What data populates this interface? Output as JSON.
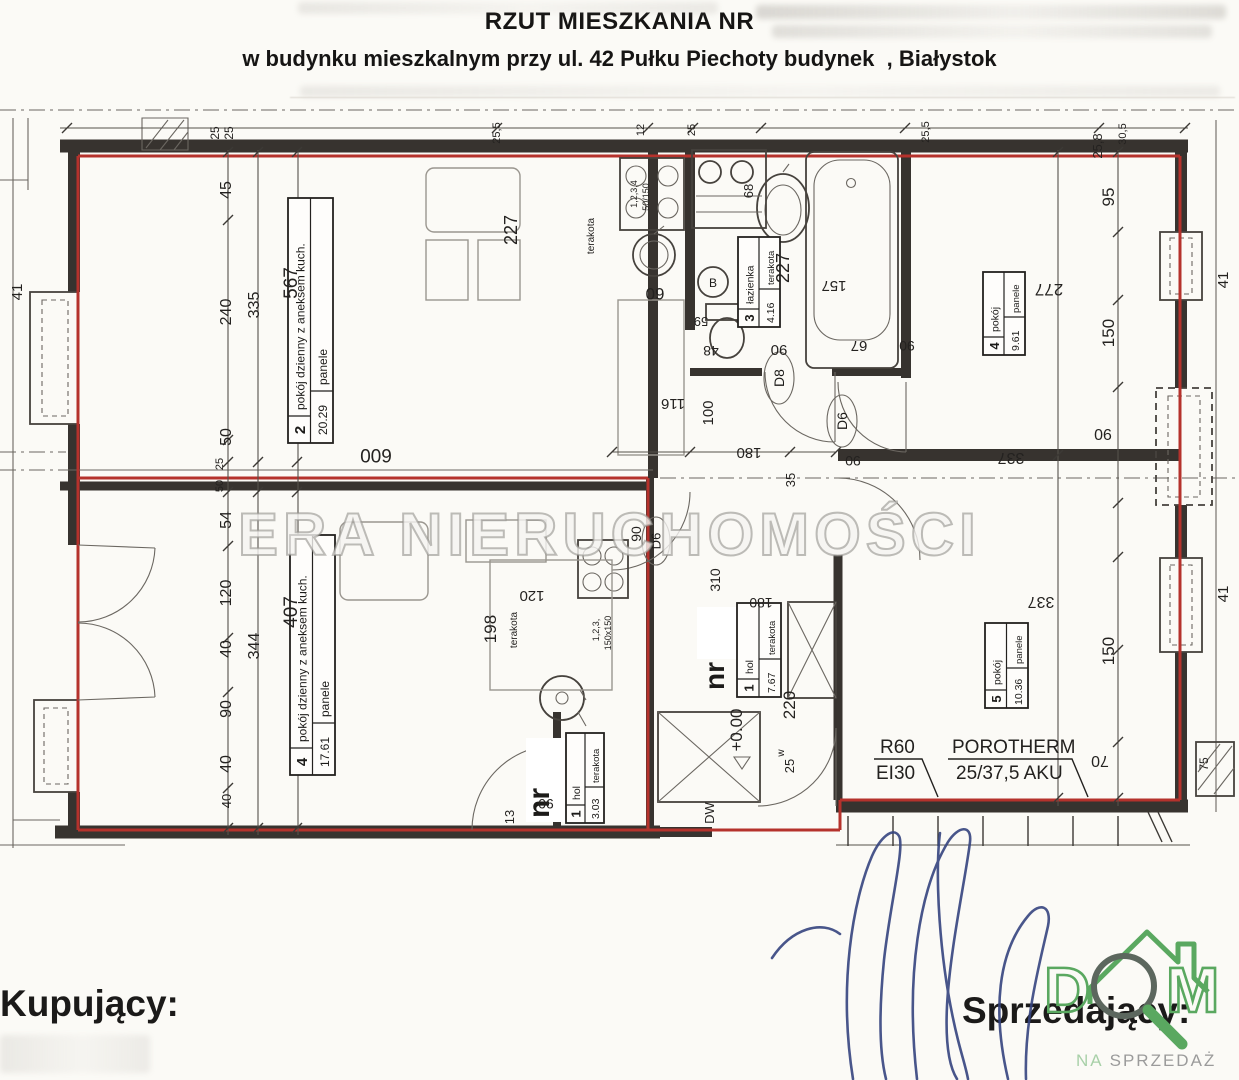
{
  "header": {
    "title": "RZUT MIESZKANIA NR",
    "subtitle": "w budynku mieszkalnym przy ul. 42 Pułku Piechoty budynek  , Białystok"
  },
  "watermark": "ERA NIERUCHOMOŚCI",
  "rooms": [
    {
      "num": "2",
      "name": "pokój dzienny z aneksem kuch.",
      "area": "20.29",
      "floor": "panele"
    },
    {
      "num": "4",
      "name": "pokój dzienny z aneksem kuch.",
      "area": "17.61",
      "floor": "panele"
    },
    {
      "num": "1",
      "name": "hol",
      "area": "3.03",
      "floor": "terakota"
    },
    {
      "num": "3",
      "name": "łazienka",
      "area": "4.16",
      "floor": "terakota"
    },
    {
      "num": "4",
      "name": "pokój",
      "area": "9.61",
      "floor": "panele"
    },
    {
      "num": "5",
      "name": "pokój",
      "area": "10.36",
      "floor": "panele"
    },
    {
      "num": "1",
      "name": "hol",
      "area": "7.67",
      "floor": "terakota"
    }
  ],
  "labels": {
    "apartment_no": "nr",
    "level": "+0.00",
    "entrance_door": "DW",
    "door_d8": "D8",
    "door_d6": "D6",
    "washer": "B",
    "fire_rating_1": "R60",
    "fire_rating_2": "EI30",
    "wall_material_1": "POROTHERM",
    "wall_material_2": "25/37,5 AKU"
  },
  "dim_labels": [
    {
      "t": "25",
      "x": 219,
      "y": 133,
      "r": -90,
      "s": 12
    },
    {
      "t": "25",
      "x": 233,
      "y": 133,
      "r": -90,
      "s": 12
    },
    {
      "t": "45",
      "x": 231,
      "y": 190,
      "r": -90,
      "s": 16
    },
    {
      "t": "240",
      "x": 231,
      "y": 312,
      "r": -90,
      "s": 16
    },
    {
      "t": "50",
      "x": 231,
      "y": 437,
      "r": -90,
      "s": 16
    },
    {
      "t": "335",
      "x": 259,
      "y": 305,
      "r": -90,
      "s": 16
    },
    {
      "t": "567",
      "x": 297,
      "y": 283,
      "r": -90,
      "s": 19
    },
    {
      "t": "600",
      "x": 376,
      "y": 449,
      "r": 180,
      "s": 19
    },
    {
      "t": "25",
      "x": 223,
      "y": 464,
      "r": -90,
      "s": 11
    },
    {
      "t": "50",
      "x": 223,
      "y": 486,
      "r": -90,
      "s": 11
    },
    {
      "t": "54",
      "x": 231,
      "y": 520,
      "r": -90,
      "s": 16
    },
    {
      "t": "120",
      "x": 231,
      "y": 593,
      "r": -90,
      "s": 16
    },
    {
      "t": "40",
      "x": 231,
      "y": 649,
      "r": -90,
      "s": 16
    },
    {
      "t": "90",
      "x": 231,
      "y": 709,
      "r": -90,
      "s": 16
    },
    {
      "t": "40",
      "x": 231,
      "y": 764,
      "r": -90,
      "s": 16
    },
    {
      "t": "344",
      "x": 259,
      "y": 646,
      "r": -90,
      "s": 16
    },
    {
      "t": "407",
      "x": 297,
      "y": 612,
      "r": -90,
      "s": 19
    },
    {
      "t": "40",
      "x": 231,
      "y": 801,
      "r": -90,
      "s": 13
    },
    {
      "t": "41",
      "x": 22,
      "y": 292,
      "r": -90,
      "s": 15
    },
    {
      "t": "41",
      "x": 1228,
      "y": 280,
      "r": -90,
      "s": 15
    },
    {
      "t": "41",
      "x": 1228,
      "y": 594,
      "r": -90,
      "s": 15
    },
    {
      "t": "13",
      "x": 514,
      "y": 817,
      "r": -90,
      "s": 13
    },
    {
      "t": "90",
      "x": 546,
      "y": 799,
      "r": 180,
      "s": 14
    },
    {
      "t": "25,5",
      "x": 500,
      "y": 133,
      "r": -90,
      "s": 11
    },
    {
      "t": "12",
      "x": 644,
      "y": 130,
      "r": -90,
      "s": 11
    },
    {
      "t": "25",
      "x": 695,
      "y": 130,
      "r": -90,
      "s": 11
    },
    {
      "t": "25,5",
      "x": 929,
      "y": 132,
      "r": -90,
      "s": 11
    },
    {
      "t": "30,5",
      "x": 1126,
      "y": 134,
      "r": -90,
      "s": 11
    },
    {
      "t": "25,8",
      "x": 1102,
      "y": 146,
      "r": -90,
      "s": 13
    },
    {
      "t": "227",
      "x": 517,
      "y": 230,
      "r": -90,
      "s": 18
    },
    {
      "t": "terakota",
      "x": 594,
      "y": 236,
      "r": -90,
      "s": 10
    },
    {
      "t": "1,2,3,4",
      "x": 637,
      "y": 194,
      "r": -90,
      "s": 9
    },
    {
      "t": "50/150",
      "x": 649,
      "y": 197,
      "r": -90,
      "s": 9
    },
    {
      "t": "60",
      "x": 655,
      "y": 288,
      "r": 180,
      "s": 17
    },
    {
      "t": "59",
      "x": 701,
      "y": 317,
      "r": 180,
      "s": 13
    },
    {
      "t": "48",
      "x": 711,
      "y": 346,
      "r": 180,
      "s": 14
    },
    {
      "t": "68",
      "x": 753,
      "y": 191,
      "r": -90,
      "s": 13
    },
    {
      "t": "227",
      "x": 789,
      "y": 268,
      "r": -90,
      "s": 18
    },
    {
      "t": "157",
      "x": 834,
      "y": 281,
      "r": 180,
      "s": 15
    },
    {
      "t": "90",
      "x": 779,
      "y": 345,
      "r": 180,
      "s": 15
    },
    {
      "t": "67",
      "x": 859,
      "y": 341,
      "r": 180,
      "s": 15
    },
    {
      "t": "116",
      "x": 673,
      "y": 399,
      "r": 180,
      "s": 15
    },
    {
      "t": "100",
      "x": 713,
      "y": 413,
      "r": -90,
      "s": 15
    },
    {
      "t": "180",
      "x": 749,
      "y": 448,
      "r": 180,
      "s": 15
    },
    {
      "t": "35",
      "x": 795,
      "y": 480,
      "r": -90,
      "s": 13
    },
    {
      "t": "90",
      "x": 641,
      "y": 534,
      "r": -90,
      "s": 14
    },
    {
      "t": "90",
      "x": 853,
      "y": 456,
      "r": 180,
      "s": 14
    },
    {
      "t": "310",
      "x": 720,
      "y": 580,
      "r": -90,
      "s": 14
    },
    {
      "t": "180",
      "x": 761,
      "y": 598,
      "r": 180,
      "s": 14
    },
    {
      "t": "120",
      "x": 532,
      "y": 591,
      "r": 180,
      "s": 15
    },
    {
      "t": "198",
      "x": 496,
      "y": 629,
      "r": -90,
      "s": 17
    },
    {
      "t": "terakota",
      "x": 517,
      "y": 630,
      "r": -90,
      "s": 10
    },
    {
      "t": "1,2,3,",
      "x": 599,
      "y": 630,
      "r": -90,
      "s": 9
    },
    {
      "t": "150x150",
      "x": 611,
      "y": 633,
      "r": -90,
      "s": 9
    },
    {
      "t": "+0.00",
      "x": 742,
      "y": 730,
      "r": -90,
      "s": 17
    },
    {
      "t": "220",
      "x": 795,
      "y": 705,
      "r": -90,
      "s": 17
    },
    {
      "t": "w",
      "x": 784,
      "y": 753,
      "r": -90,
      "s": 10
    },
    {
      "t": "25",
      "x": 794,
      "y": 766,
      "r": -90,
      "s": 13
    },
    {
      "t": "DW",
      "x": 714,
      "y": 813,
      "r": -90,
      "s": 13
    },
    {
      "t": "95",
      "x": 1114,
      "y": 197,
      "r": -90,
      "s": 17
    },
    {
      "t": "150",
      "x": 1114,
      "y": 333,
      "r": -90,
      "s": 17
    },
    {
      "t": "90",
      "x": 1103,
      "y": 429,
      "r": 180,
      "s": 16
    },
    {
      "t": "277",
      "x": 1049,
      "y": 284,
      "r": 180,
      "s": 17
    },
    {
      "t": "337",
      "x": 1011,
      "y": 453,
      "r": 180,
      "s": 16
    },
    {
      "t": "337",
      "x": 1041,
      "y": 597,
      "r": 180,
      "s": 16
    },
    {
      "t": "150",
      "x": 1114,
      "y": 651,
      "r": -90,
      "s": 17
    },
    {
      "t": "70",
      "x": 1100,
      "y": 756,
      "r": 180,
      "s": 16
    },
    {
      "t": "75",
      "x": 1208,
      "y": 764,
      "r": -90,
      "s": 12
    },
    {
      "t": "90",
      "x": 907,
      "y": 341,
      "r": 180,
      "s": 14
    }
  ],
  "signing": {
    "buyer_label": "Kupujący:",
    "seller_label": "Sprzedający:"
  },
  "logo": {
    "letter_d": "D",
    "letter_m": "M",
    "tagline_na": "NA",
    "tagline_sprzedaz": "SPRZEDAŻ"
  },
  "colors": {
    "boundary_red": "#b5322c",
    "wall_black": "#37332f",
    "signature_blue": "#35447f",
    "logo_green": "#5aa860",
    "logo_light_green": "#a8d0a8",
    "logo_gray": "#9b9b9b"
  }
}
